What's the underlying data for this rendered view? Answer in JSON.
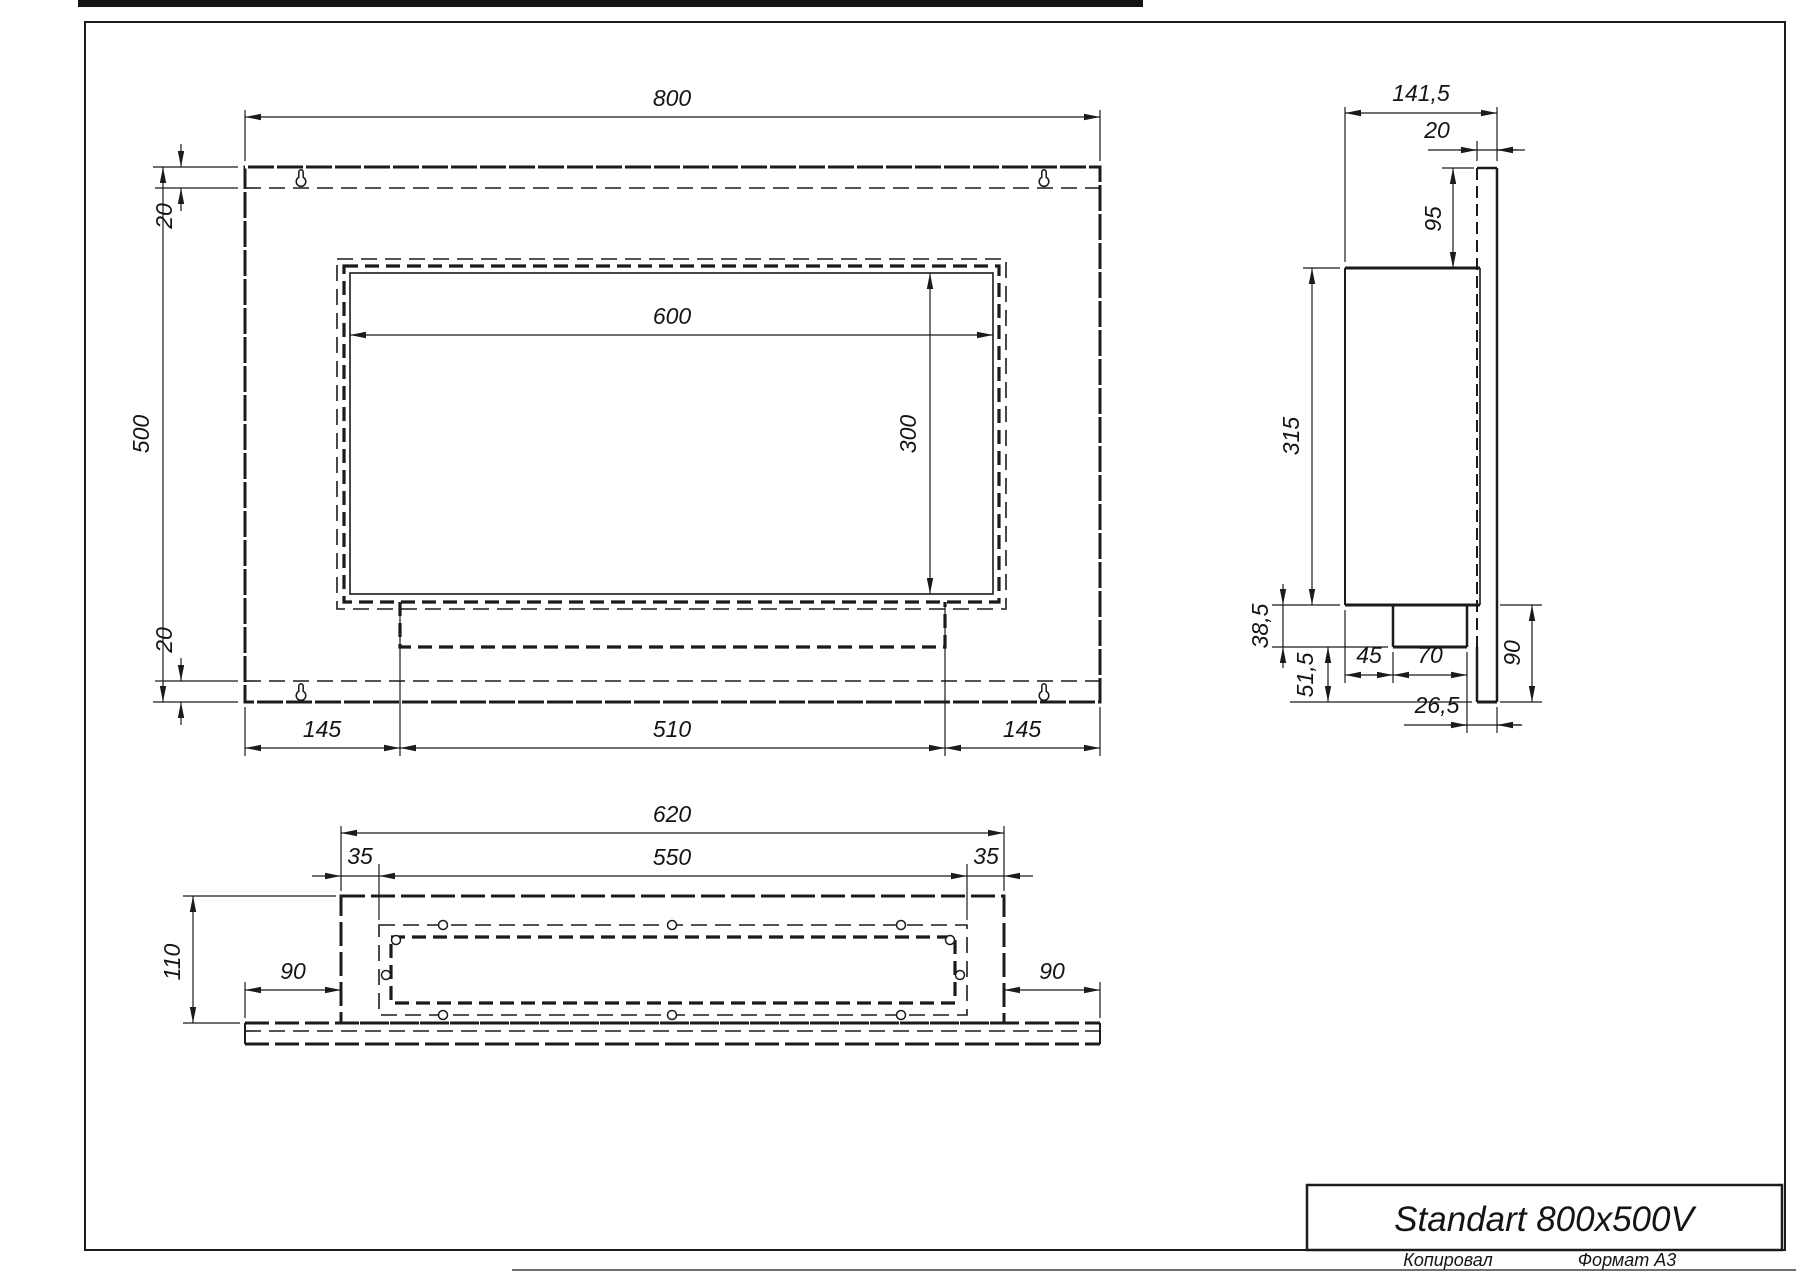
{
  "title_block": {
    "title": "Standart 800x500V",
    "copied": "Копировал",
    "format": "Формат А3"
  },
  "front_view": {
    "width": "800",
    "height": "500",
    "offset_top": "20",
    "offset_bottom": "20",
    "opening_width": "600",
    "opening_height": "300",
    "margin_left": "145",
    "tray_width": "510",
    "margin_right": "145"
  },
  "side_view": {
    "depth": "141,5",
    "plate_thickness": "20",
    "top_inset": "95",
    "body_height": "315",
    "tray_depth": "38,5",
    "bottom_inset": "51,5",
    "front_gap": "45",
    "tray_width": "70",
    "lower_height": "90",
    "back_gap": "26,5"
  },
  "bottom_view": {
    "outer_width": "620",
    "inner_width": "550",
    "margin_left": "35",
    "margin_right": "35",
    "depth": "110",
    "flange_left": "90",
    "flange_right": "90"
  },
  "icons": {
    "keyhole_slot": "keyhole-shaped wall-mount slot",
    "mounting_hole": "small circular screw hole"
  }
}
